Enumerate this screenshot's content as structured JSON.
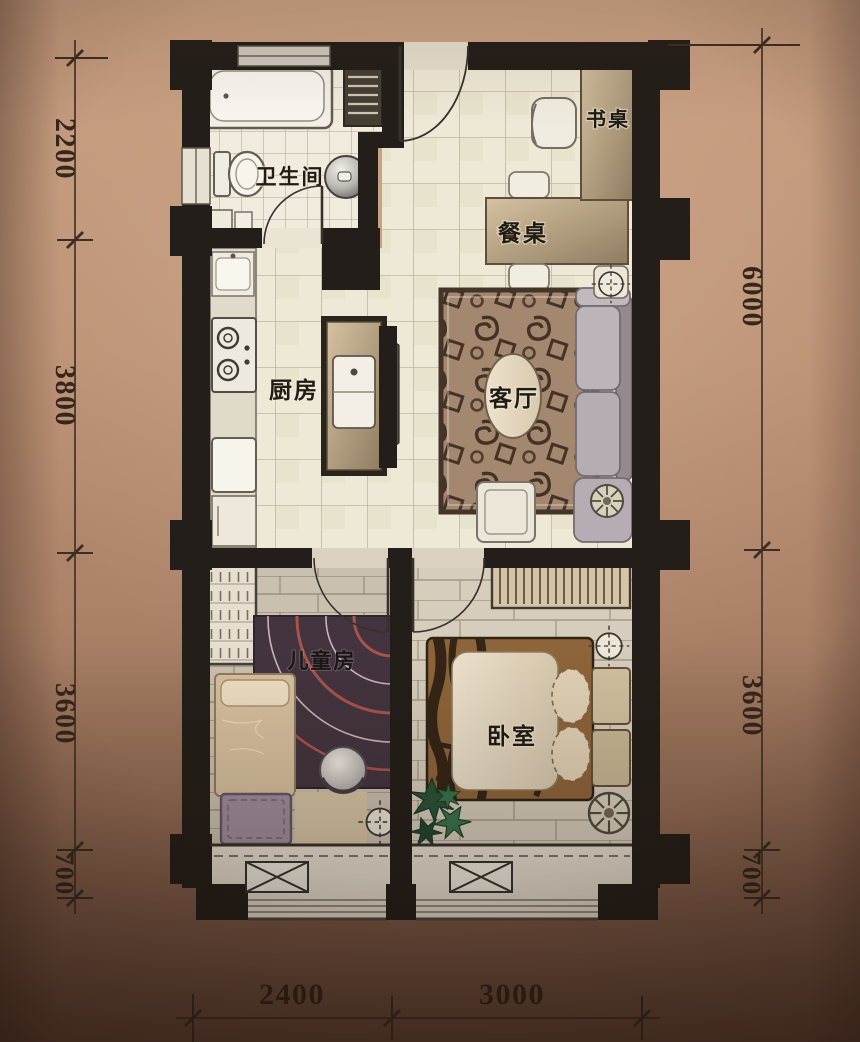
{
  "figure": {
    "kind": "apartment floor plan photo"
  },
  "rooms": {
    "bathroom": "卫生间",
    "kitchen": "厨房",
    "living_room": "客厅",
    "dining_table": "餐桌",
    "desk": "书桌",
    "kids_room": "儿童房",
    "bedroom": "卧室"
  },
  "dimensions": {
    "left": [
      "2200",
      "3800",
      "3600",
      "700"
    ],
    "right": [
      "6000",
      "3600",
      "700"
    ],
    "bottom": [
      "2400",
      "3000"
    ]
  },
  "colors": {
    "background_bronze": "#b28a6e",
    "wall_black": "#171513",
    "floor_tile_cream": "#f1eede",
    "wood_floor": "#cfc7b8",
    "rug_brown": "#a1876f",
    "dimension_text": "#2b1f15"
  }
}
